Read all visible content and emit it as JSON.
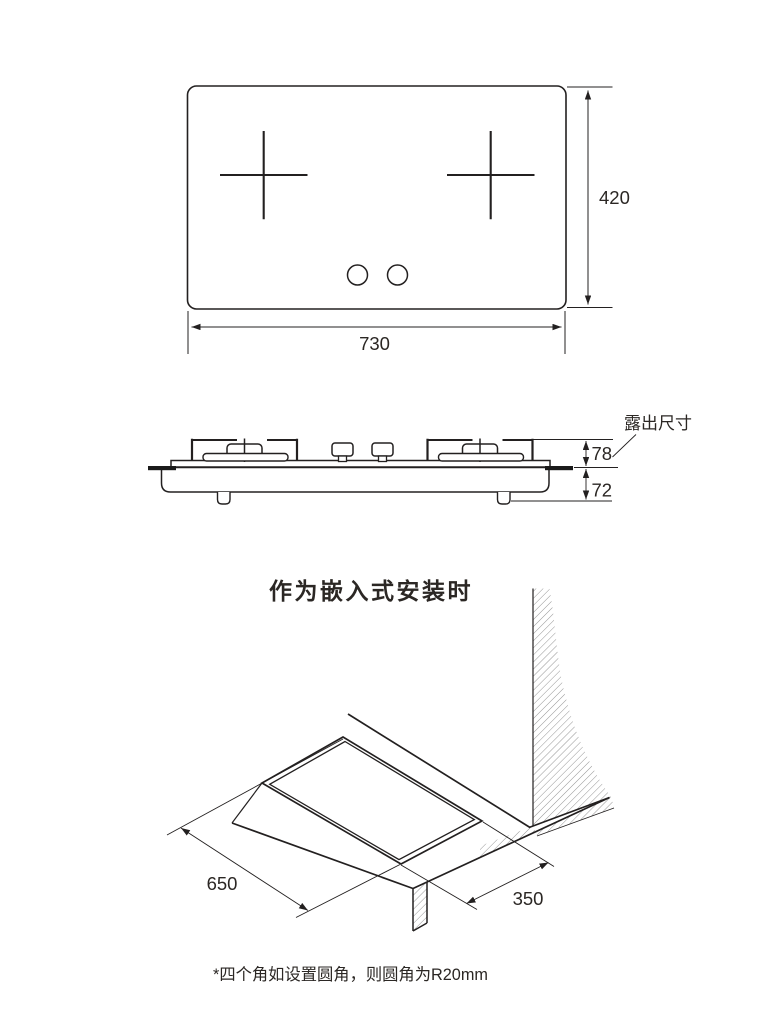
{
  "colors": {
    "line": "#232020",
    "hatch": "#8a8a8a",
    "background": "#ffffff",
    "glass_edge": "#1a1a1a"
  },
  "top_view": {
    "width_label": "730",
    "height_label": "420"
  },
  "side_view": {
    "exposed_label": "露出尺寸",
    "above_counter_label": "78",
    "below_counter_label": "72"
  },
  "embedded_view": {
    "title": "作为嵌入式安装时",
    "cutout_length_label": "650",
    "cutout_depth_label": "350"
  },
  "footnote": {
    "text": "*四个角如设置圆角，则圆角为R20mm"
  }
}
